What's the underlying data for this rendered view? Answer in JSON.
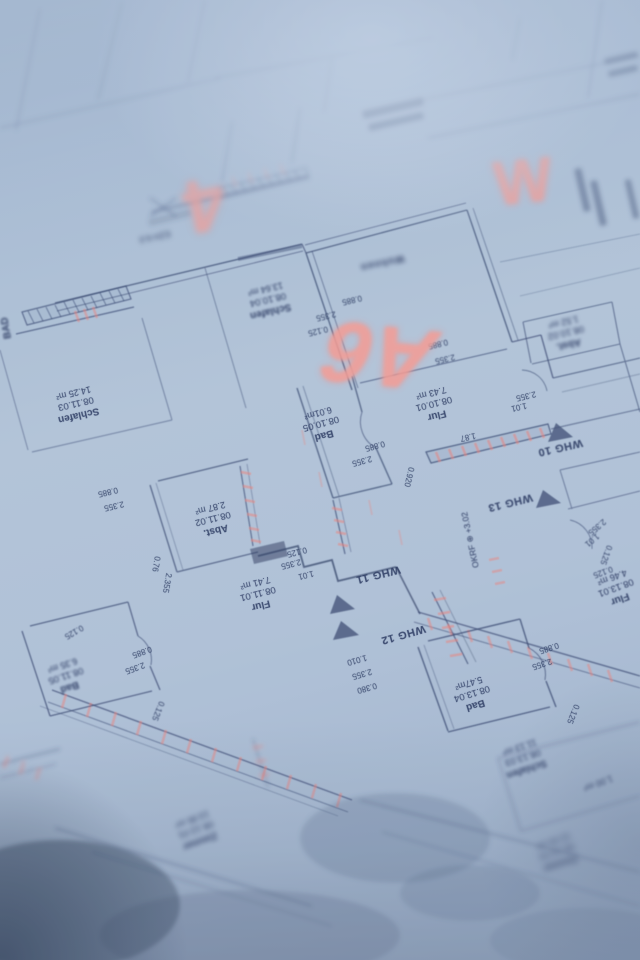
{
  "palette": {
    "paper": "#b3c4d8",
    "ink": "#33436b",
    "marker_red": "#ff9b8f",
    "wall_highlight": "#f2837a"
  },
  "red_marks": [
    {
      "label": "4"
    },
    {
      "label": "W"
    },
    {
      "label": "A6"
    }
  ],
  "apartments": [
    {
      "label": "WHG 10"
    },
    {
      "label": "WHG 11"
    },
    {
      "label": "WHG 12"
    },
    {
      "label": "WHG 13"
    }
  ],
  "rooms": [
    {
      "name": "Schlafen",
      "number": "08.10.04",
      "area": "13.64 m²"
    },
    {
      "name": "Schlafen",
      "number": "08.11.03",
      "area": "14.25 m²"
    },
    {
      "name": "Bad",
      "number": "08.10.05",
      "area": "6.01m²"
    },
    {
      "name": "Flur",
      "number": "08.10.01",
      "area": "7.43 m²"
    },
    {
      "name": "Abst.",
      "number": "08.10.02",
      "area": "1.52 m²"
    },
    {
      "name": "Abst.",
      "number": "08.11.02",
      "area": "2.87 m²"
    },
    {
      "name": "Flur",
      "number": "08.11.01",
      "area": "7.41 m²"
    },
    {
      "name": "Bad",
      "number": "08.11.05",
      "area": "6.35 m²"
    },
    {
      "name": "Bad",
      "number": "08.13.04",
      "area": "5.47m²"
    },
    {
      "name": "Flur",
      "number": "08.13.01",
      "area": "4.46 m²"
    },
    {
      "name": "Schlafen",
      "number": "08.13.03",
      "area": "11.13 m²"
    },
    {
      "name": "Zimmer",
      "number": "08.12.01",
      "area": "13.95 m²"
    },
    {
      "name": "Zimmer",
      "number": "08.13.02",
      "area": "12.43 m²"
    }
  ],
  "labels": {
    "level": "OKRF ⊕ +3.02",
    "ezh": "EZH 6.0",
    "bad_edge": "BAD",
    "one_meter": "1.00 m²",
    "wohnen": "Wohnen"
  },
  "dims": [
    "0.885",
    "2.355",
    "0.125",
    "0.885",
    "2.355",
    "0.885",
    "2.355",
    "0.920",
    "1.87",
    "2.355",
    "1.01",
    "0.885",
    "2.355",
    "0.76",
    "2.355",
    "0.125",
    "2.355",
    "1.01",
    "1.010",
    "2.355",
    "0.380",
    "2.355",
    "1.01",
    "0.125",
    "0.125",
    "0.885",
    "2.355",
    "0.125",
    "0.125",
    "0.885",
    "2.355",
    "0.125"
  ]
}
